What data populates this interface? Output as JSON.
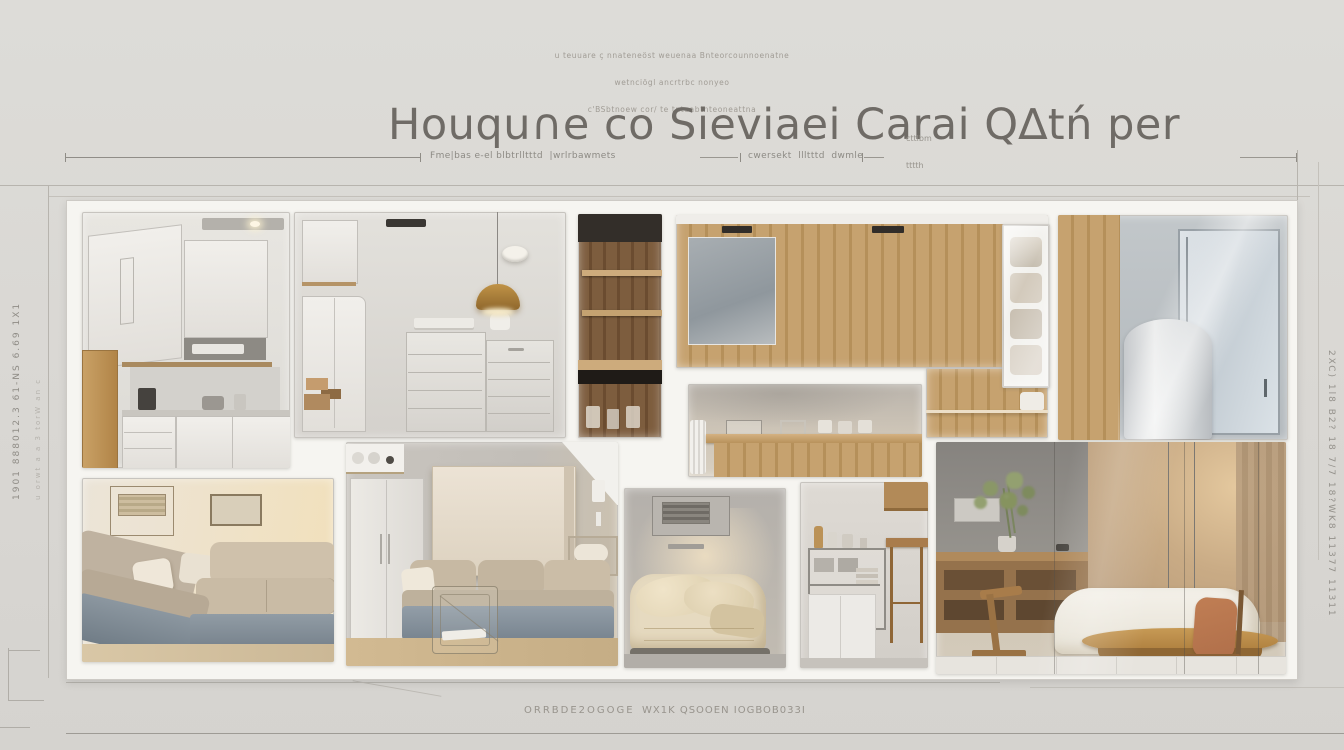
{
  "palette": {
    "background": "#d9d7d3",
    "wall_white": "#f6f5f1",
    "wood": "#c3a071",
    "wood_dark": "#7a5a3b",
    "pendant_gold": "#c09347",
    "sofa_base": "#8c97a0",
    "cushion": "#c9bba5",
    "chair_rust": "#b06f4a",
    "glow_warm": "#f0dcb4",
    "line_gray": "#908d88",
    "text_gray": "#716d68"
  },
  "annotations": {
    "top_block": {
      "line1": "u teuuare ç nnateneöst weuenaa Bnteorcounnoenatne",
      "line2": "wetnciögl ancrtrbc nonyeo",
      "line3": "c'BSbtnoew cor/ te tnteabtnteoneattna"
    },
    "title": {
      "text": "Houqu∩e co Sieviaei Carai Q∆tń per",
      "suffix_line1": "cttlbm",
      "suffix_line2": "tttth"
    },
    "dimension_row": {
      "left_label": "Fme|bas e-el blbtrlltttd  |wrlrbawmets",
      "right_label": "cwersekt  llltttd  dwmle"
    },
    "side_labels": {
      "left_vertical": "1901 888012.3 61-NS 6.69 1X1",
      "left_vertical_2": "u orwt a a 3 torW an c",
      "right_vertical": "2XC) 1l8 B2? 18 7/7 18?WK8 11377 11311"
    },
    "bottom_row": {
      "left_text": "ORRBDE2OGOGE",
      "right_text": "WX1K QSOOEN IOGBOB033I"
    }
  }
}
